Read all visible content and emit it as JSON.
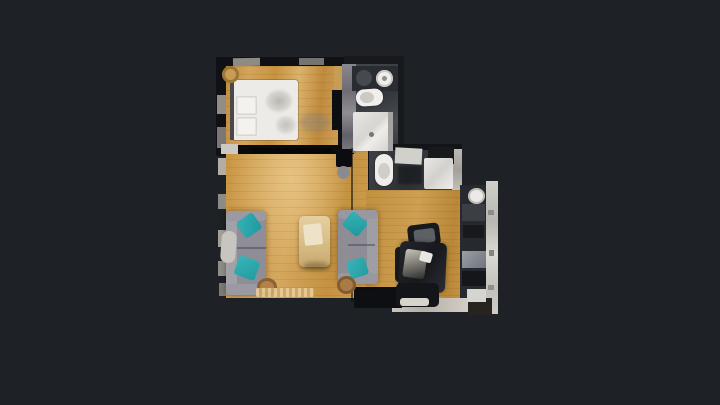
{
  "canvas": {
    "width": 720,
    "height": 405,
    "background": "#1e2125"
  },
  "palette": {
    "background": "#1e2125",
    "wood_light": "#d9b36b",
    "wood_mid": "#c99a4e",
    "wall_dark": "#0f1114",
    "fixture_white": "#ecebe7",
    "sofa_gray": "#8f8d95",
    "pillow_teal": "#2ba6ab",
    "kitchen_counter": "#cfcdc8"
  },
  "scene": {
    "description": "Top-down photogrammetry floor plan of an apartment on a dark viewer background",
    "rooms": [
      "bedroom",
      "bathroom",
      "toilet-laundry",
      "living-room",
      "dining-area",
      "kitchen"
    ],
    "elements": [
      {
        "name": "bedroom-wall-block",
        "x": 216,
        "y": 57,
        "w": 141,
        "h": 99,
        "bg": "#0f1114",
        "br": "2px"
      },
      {
        "name": "bedroom-floor",
        "x": 226,
        "y": 66,
        "w": 112,
        "h": 84,
        "bg": "repeating-linear-gradient(180deg, rgba(90,60,15,0.10) 0px, rgba(90,60,15,0.10) 1px, rgba(0,0,0,0) 1px, rgba(0,0,0,0) 8px), linear-gradient(95deg,#c28c3e 0%,#d3a55c 20%,#c6933f 42%,#dbb26b 62%,#c08a3c 82%,#cfa057 100%)"
      },
      {
        "name": "bedroom-floor-extension",
        "x": 334,
        "y": 66,
        "w": 12,
        "h": 30,
        "bg": "#c79c55"
      },
      {
        "name": "bathroom-wall-block",
        "x": 344,
        "y": 56,
        "w": 60,
        "h": 101,
        "bg": "#17191d",
        "br": "2px"
      },
      {
        "name": "bathroom-floor",
        "x": 350,
        "y": 64,
        "w": 48,
        "h": 89,
        "bg": "linear-gradient(160deg,#44474c,#33363b 40%,#4a4d52 70%,#303338)"
      },
      {
        "name": "toilet-room-wall-block",
        "x": 363,
        "y": 144,
        "w": 99,
        "h": 48,
        "bg": "#121417",
        "br": "2px"
      },
      {
        "name": "toilet-room-floor",
        "x": 369,
        "y": 150,
        "w": 84,
        "h": 40,
        "bg": "linear-gradient(105deg,#3d4045,#2c2f34 50%,#41444a)"
      },
      {
        "name": "toilet-room-right-wall",
        "x": 452,
        "y": 149,
        "w": 10,
        "h": 42,
        "bg": "linear-gradient(180deg,#bcb9b3,#a3a09a 50%,#c4c1bb)"
      },
      {
        "name": "living-room-floor",
        "x": 226,
        "y": 151,
        "w": 142,
        "h": 147,
        "bg": "repeating-linear-gradient(180deg, rgba(90,60,15,0.09) 0px, rgba(90,60,15,0.09) 1px, rgba(0,0,0,0) 1px, rgba(0,0,0,0) 8px), radial-gradient(ellipse at 45% 18%, rgba(232,198,133,0.9) 0%, rgba(232,198,133,0) 55%), linear-gradient(100deg,#c89544,#d5a75f 45%,#c3913f 75%,#d0a255)"
      },
      {
        "name": "dining-area-floor",
        "x": 366,
        "y": 190,
        "w": 97,
        "h": 118,
        "bg": "repeating-linear-gradient(180deg, rgba(85,55,12,0.10) 0px, rgba(85,55,12,0.10) 1px, rgba(0,0,0,0) 1px, rgba(0,0,0,0) 7px), linear-gradient(95deg,#c1913f,#cf9f52 50%,#b98737 85%,#c79544)"
      },
      {
        "name": "kitchen-appliance-band",
        "x": 460,
        "y": 185,
        "w": 28,
        "h": 127,
        "bg": "#26292e"
      },
      {
        "name": "kitchen-counter-wall",
        "x": 486,
        "y": 181,
        "w": 12,
        "h": 133,
        "bg": "linear-gradient(180deg,#d2d0cb,#b9b7b2 30%,#dcdad5 55%,#c2c0bb 80%,#cfcdc8)"
      },
      {
        "name": "dining-bottom-bench",
        "x": 392,
        "y": 298,
        "w": 76,
        "h": 14,
        "bg": "linear-gradient(90deg,#cac5bc,#b5b0a7 40%,#d3cec5)"
      },
      {
        "name": "plan-bottom-right-tip",
        "x": 468,
        "y": 298,
        "w": 24,
        "h": 17,
        "bg": "#262321"
      },
      {
        "name": "bedroom-top-wall-chip",
        "x": 233,
        "y": 58,
        "w": 27,
        "h": 8,
        "bg": "#8e8b85",
        "rot": -1
      },
      {
        "name": "bedroom-top-wall-chip-2",
        "x": 299,
        "y": 58,
        "w": 25,
        "h": 7,
        "bg": "#767471"
      },
      {
        "name": "bedroom-left-wall-chip",
        "x": 217,
        "y": 95,
        "w": 9,
        "h": 19,
        "bg": "#918d87"
      },
      {
        "name": "bedroom-left-wall-chip-2",
        "x": 217,
        "y": 127,
        "w": 9,
        "h": 21,
        "bg": "#7b7873"
      },
      {
        "name": "bedroom-bottom-wall",
        "x": 226,
        "y": 145,
        "w": 128,
        "h": 9,
        "bg": "#0a0b0d"
      },
      {
        "name": "bedroom-door-chip",
        "x": 221,
        "y": 144,
        "w": 17,
        "h": 10,
        "bg": "#ccc9c3"
      },
      {
        "name": "door-leaf",
        "x": 252,
        "y": 148,
        "w": 80,
        "h": 5,
        "bg": "#060708"
      },
      {
        "name": "wardrobe-void",
        "x": 332,
        "y": 90,
        "w": 18,
        "h": 40,
        "bg": "#0d0e11"
      },
      {
        "name": "closet-wall-strip",
        "x": 342,
        "y": 64,
        "w": 14,
        "h": 89,
        "bg": "linear-gradient(180deg,#8a888d,#6e6c72 30%,#8f8d92 55%,#606067 80%,#7d7b80)"
      },
      {
        "name": "living-left-wall-chip-1",
        "x": 218,
        "y": 158,
        "w": 8,
        "h": 17,
        "bg": "#b2aea7"
      },
      {
        "name": "living-left-wall-chip-2",
        "x": 218,
        "y": 194,
        "w": 8,
        "h": 15,
        "bg": "#8e8b85"
      },
      {
        "name": "living-left-wall-chip-3",
        "x": 218,
        "y": 230,
        "w": 8,
        "h": 17,
        "bg": "#a4a09a"
      },
      {
        "name": "living-left-wall-chip-4",
        "x": 218,
        "y": 261,
        "w": 8,
        "h": 15,
        "bg": "#918d87"
      },
      {
        "name": "living-left-wall-chip-5",
        "x": 219,
        "y": 283,
        "w": 7,
        "h": 13,
        "bg": "#7e7b76"
      },
      {
        "name": "scan-seam-line",
        "x": 351,
        "y": 148,
        "w": 2,
        "h": 154,
        "bg": "rgba(8,9,11,0.55)"
      },
      {
        "name": "dining-bottom-left-wall",
        "x": 354,
        "y": 287,
        "w": 48,
        "h": 21,
        "bg": "#0d0f12"
      },
      {
        "name": "bed",
        "x": 232,
        "y": 80,
        "w": 66,
        "h": 60,
        "bg": "#ecebe7",
        "br": "3px",
        "sh": "0 0 0 1px rgba(0,0,0,0.18)"
      },
      {
        "name": "bed-headboard",
        "x": 230,
        "y": 80,
        "w": 4,
        "h": 60,
        "bg": "#4a4946"
      },
      {
        "name": "bed-pillow",
        "x": 236,
        "y": 96,
        "w": 21,
        "h": 19,
        "bg": "#f3f2ef",
        "br": "2px",
        "sh": "inset 0 0 0 1.5px #d7d6d2"
      },
      {
        "name": "bed-pillow-2",
        "x": 236,
        "y": 117,
        "w": 21,
        "h": 19,
        "bg": "#f3f2ef",
        "br": "2px",
        "sh": "inset 0 0 0 1.5px #d7d6d2"
      },
      {
        "name": "duvet-wrinkle",
        "x": 266,
        "y": 90,
        "w": 26,
        "h": 22,
        "bg": "radial-gradient(ellipse, rgba(140,138,130,0.55), rgba(140,138,130,0))",
        "br": "50%",
        "blur": 1
      },
      {
        "name": "duvet-wrinkle-2",
        "x": 276,
        "y": 116,
        "w": 20,
        "h": 18,
        "bg": "radial-gradient(ellipse, rgba(150,148,140,0.5), rgba(150,148,140,0))",
        "br": "50%",
        "blur": 1
      },
      {
        "name": "bedside-stool",
        "x": 222,
        "y": 66,
        "w": 17,
        "h": 17,
        "bg": "#c89c51",
        "br": "50%",
        "sh": "inset 0 0 0 3px #9a7638"
      },
      {
        "name": "bedroom-floor-smudge",
        "x": 300,
        "y": 113,
        "w": 30,
        "h": 19,
        "bg": "rgba(130,128,122,0.4)",
        "br": "50%",
        "blur": 2
      },
      {
        "name": "bathroom-vanity-counter",
        "x": 352,
        "y": 66,
        "w": 46,
        "h": 25,
        "bg": "#292c31"
      },
      {
        "name": "bathroom-dark-basin",
        "x": 356,
        "y": 70,
        "w": 16,
        "h": 16,
        "bg": "#46494e",
        "br": "50%"
      },
      {
        "name": "bathroom-sink",
        "x": 376,
        "y": 70,
        "w": 17,
        "h": 17,
        "bg": "#efeeeb",
        "br": "50%",
        "sh": "inset 0 0 0 2px #c9c8c4"
      },
      {
        "name": "bathroom-sink-drain",
        "x": 382,
        "y": 76,
        "w": 5,
        "h": 5,
        "bg": "#8f8e94",
        "br": "50%"
      },
      {
        "name": "toilet",
        "x": 356,
        "y": 89,
        "w": 27,
        "h": 17,
        "bg": "#f0efec",
        "br": "8px",
        "rot": -4,
        "sh": "0 0 2px rgba(0,0,0,0.4)"
      },
      {
        "name": "toilet-seat",
        "x": 360,
        "y": 92,
        "w": 14,
        "h": 11,
        "bg": "rgba(200,199,195,0.95)",
        "br": "50%"
      },
      {
        "name": "shower-tray",
        "x": 353,
        "y": 112,
        "w": 40,
        "h": 39,
        "bg": "linear-gradient(135deg,#e8e7e4 0%,#d6d5d2 45%,#eeedea 60%,#cfcecb 100%)",
        "br": "2px"
      },
      {
        "name": "shower-glass-edge",
        "x": 388,
        "y": 112,
        "w": 5,
        "h": 39,
        "bg": "#a3a4a2"
      },
      {
        "name": "shower-drain",
        "x": 369,
        "y": 132,
        "w": 5,
        "h": 5,
        "bg": "#77766f",
        "br": "50%"
      },
      {
        "name": "toilet-2",
        "x": 375,
        "y": 154,
        "w": 18,
        "h": 32,
        "bg": "#eeede9",
        "br": "9px",
        "sh": "0 0 2px rgba(0,0,0,0.4)"
      },
      {
        "name": "toilet-2-seat",
        "x": 378,
        "y": 163,
        "w": 12,
        "h": 16,
        "bg": "rgba(205,204,200,0.95)",
        "br": "50%"
      },
      {
        "name": "toilet-room-sink-chip",
        "x": 395,
        "y": 148,
        "w": 27,
        "h": 16,
        "bg": "#d2d0cb",
        "rot": 3
      },
      {
        "name": "toilet-room-dark-corner",
        "x": 428,
        "y": 147,
        "w": 26,
        "h": 17,
        "bg": "#17191d"
      },
      {
        "name": "washing-machine",
        "x": 424,
        "y": 158,
        "w": 29,
        "h": 31,
        "bg": "linear-gradient(135deg,#e9e8e5,#d2d1ce 50%,#efeeeb)",
        "br": "2px"
      },
      {
        "name": "toilet-room-floor-clutter",
        "x": 398,
        "y": 166,
        "w": 24,
        "h": 18,
        "bg": "rgba(20,22,25,0.6)",
        "blur": 1
      },
      {
        "name": "tv-unit",
        "x": 336,
        "y": 149,
        "w": 16,
        "h": 18,
        "bg": "#0a0c0f",
        "br": "2px"
      },
      {
        "name": "tv-side-disc",
        "x": 337,
        "y": 166,
        "w": 13,
        "h": 13,
        "bg": "#8b8a90",
        "br": "50%"
      },
      {
        "name": "sofa-left-body",
        "x": 226,
        "y": 211,
        "w": 40,
        "h": 84,
        "bg": "#8f8d95",
        "br": "4px",
        "sh": "0 0 6px rgba(0,0,0,0.35)"
      },
      {
        "name": "sofa-left-backrest",
        "x": 226,
        "y": 211,
        "w": 11,
        "h": 84,
        "bg": "#a3a1a8",
        "br": "4px"
      },
      {
        "name": "sofa-left-armrest-top",
        "x": 226,
        "y": 211,
        "w": 40,
        "h": 10,
        "bg": "#9b99a1",
        "br": "4px"
      },
      {
        "name": "sofa-left-armrest-bottom",
        "x": 226,
        "y": 284,
        "w": 40,
        "h": 11,
        "bg": "#9b99a1",
        "br": "4px"
      },
      {
        "name": "sofa-left-cushion-split",
        "x": 237,
        "y": 247,
        "w": 29,
        "h": 2,
        "bg": "rgba(70,70,78,0.5)"
      },
      {
        "name": "sofa-left-throw-blanket",
        "x": 221,
        "y": 231,
        "w": 15,
        "h": 32,
        "bg": "#c8c5c1",
        "br": "7px",
        "rot": 4
      },
      {
        "name": "teal-pillow-1",
        "x": 239,
        "y": 216,
        "w": 20,
        "h": 19,
        "bg": "linear-gradient(135deg,#35b2b6,#1f989e)",
        "br": "3px",
        "rot": -35
      },
      {
        "name": "teal-pillow-2",
        "x": 236,
        "y": 258,
        "w": 22,
        "h": 20,
        "bg": "linear-gradient(135deg,#38b5b9,#239ba1)",
        "br": "3px",
        "rot": 20
      },
      {
        "name": "wicker-basket-1",
        "x": 257,
        "y": 278,
        "w": 20,
        "h": 18,
        "bg": "#b2824a",
        "br": "50%",
        "sh": "inset 0 0 0 3px #8a6233"
      },
      {
        "name": "rug-fringe",
        "x": 256,
        "y": 288,
        "w": 58,
        "h": 9,
        "bg": "repeating-linear-gradient(90deg, rgba(235,205,150,0.9) 0 3px, rgba(205,170,110,0.9) 3px 6px)",
        "br": "2px"
      },
      {
        "name": "coffee-table",
        "x": 299,
        "y": 216,
        "w": 31,
        "h": 51,
        "bg": "linear-gradient(180deg,#e5cfa0 0%,#dbc08c 45%,#c8a970 100%)",
        "br": "5px",
        "sh": "0 2px 4px rgba(0,0,0,0.35)"
      },
      {
        "name": "coffee-table-books",
        "x": 304,
        "y": 224,
        "w": 18,
        "h": 21,
        "bg": "#eee3c8",
        "br": "2px",
        "rot": -6
      },
      {
        "name": "coffee-table-shadow",
        "x": 303,
        "y": 262,
        "w": 26,
        "h": 8,
        "bg": "rgba(60,45,20,0.35)",
        "br": "50%",
        "blur": 2
      },
      {
        "name": "sofa-right-body",
        "x": 338,
        "y": 210,
        "w": 40,
        "h": 74,
        "bg": "#8e8c94",
        "br": "4px",
        "sh": "0 0 6px rgba(0,0,0,0.35)"
      },
      {
        "name": "sofa-right-backrest",
        "x": 367,
        "y": 210,
        "w": 11,
        "h": 74,
        "bg": "#a09ea5",
        "br": "4px"
      },
      {
        "name": "sofa-right-armrest-top",
        "x": 338,
        "y": 210,
        "w": 40,
        "h": 9,
        "bg": "#99979f",
        "br": "4px"
      },
      {
        "name": "sofa-right-armrest-bottom",
        "x": 338,
        "y": 273,
        "w": 40,
        "h": 11,
        "bg": "#99979f",
        "br": "4px"
      },
      {
        "name": "sofa-right-cushion-split",
        "x": 348,
        "y": 244,
        "w": 27,
        "h": 2,
        "bg": "rgba(70,70,78,0.5)"
      },
      {
        "name": "teal-pillow-3",
        "x": 345,
        "y": 215,
        "w": 20,
        "h": 18,
        "bg": "linear-gradient(135deg,#35b2b6,#1f989e)",
        "br": "3px",
        "rot": 40
      },
      {
        "name": "teal-pillow-4",
        "x": 348,
        "y": 259,
        "w": 19,
        "h": 18,
        "bg": "linear-gradient(135deg,#38b5b9,#239ba1)",
        "br": "3px",
        "rot": -18
      },
      {
        "name": "wicker-basket-2",
        "x": 337,
        "y": 276,
        "w": 19,
        "h": 18,
        "bg": "#aa7c45",
        "br": "50%",
        "sh": "inset 0 0 0 3px #825c30"
      },
      {
        "name": "dining-chair-top",
        "x": 408,
        "y": 224,
        "w": 32,
        "h": 23,
        "bg": "#17191c",
        "br": "5px",
        "rot": -7
      },
      {
        "name": "dining-chair-top-seat",
        "x": 414,
        "y": 229,
        "w": 21,
        "h": 14,
        "bg": "#5d6065",
        "br": "3px",
        "rot": -7
      },
      {
        "name": "dining-chair-left",
        "x": 395,
        "y": 247,
        "w": 17,
        "h": 35,
        "bg": "#191b1f",
        "br": "4px"
      },
      {
        "name": "dining-table",
        "x": 399,
        "y": 242,
        "w": 47,
        "h": 50,
        "bg": "linear-gradient(120deg,#23252a,#17191d 55%,#2a2d32)",
        "br": "6px",
        "rot": 3,
        "sh": "0 0 5px rgba(0,0,0,0.4)"
      },
      {
        "name": "dining-table-reflection",
        "x": 404,
        "y": 250,
        "w": 22,
        "h": 28,
        "bg": "linear-gradient(160deg, rgba(230,225,210,0.85), rgba(160,155,140,0.15))",
        "br": "3px",
        "rot": 8
      },
      {
        "name": "dining-table-plate",
        "x": 420,
        "y": 252,
        "w": 12,
        "h": 10,
        "bg": "#e9e7e1",
        "br": "2px",
        "rot": 16
      },
      {
        "name": "dining-chair-bottom",
        "x": 396,
        "y": 283,
        "w": 43,
        "h": 24,
        "bg": "#131518",
        "br": "5px"
      },
      {
        "name": "dining-chair-bottom-rim",
        "x": 400,
        "y": 298,
        "w": 29,
        "h": 8,
        "bg": "#d8d4cb",
        "br": "3px"
      },
      {
        "name": "kitchen-round-sink",
        "x": 468,
        "y": 188,
        "w": 17,
        "h": 16,
        "bg": "#eceae6",
        "br": "50%",
        "sh": "inset 0 0 0 2px #bdbbb6"
      },
      {
        "name": "kitchen-appliance-patch-1",
        "x": 462,
        "y": 204,
        "w": 23,
        "h": 17,
        "bg": "#3b3f45"
      },
      {
        "name": "kitchen-appliance-patch-2",
        "x": 463,
        "y": 225,
        "w": 21,
        "h": 13,
        "bg": "#17191d"
      },
      {
        "name": "kitchen-metal-patch",
        "x": 462,
        "y": 251,
        "w": 24,
        "h": 17,
        "bg": "linear-gradient(135deg,#9aa0a7,#6f747b)"
      },
      {
        "name": "kitchen-appliance-patch-3",
        "x": 462,
        "y": 271,
        "w": 24,
        "h": 15,
        "bg": "#14161a"
      },
      {
        "name": "kitchen-white-patch",
        "x": 467,
        "y": 289,
        "w": 19,
        "h": 13,
        "bg": "#d6d4cf"
      },
      {
        "name": "kitchen-wall-speckle-1",
        "x": 488,
        "y": 210,
        "w": 6,
        "h": 5,
        "bg": "#8e8c88"
      },
      {
        "name": "kitchen-wall-speckle-2",
        "x": 489,
        "y": 250,
        "w": 5,
        "h": 6,
        "bg": "#86847f"
      },
      {
        "name": "kitchen-wall-speckle-3",
        "x": 488,
        "y": 285,
        "w": 6,
        "h": 5,
        "bg": "#918f8a"
      }
    ]
  }
}
